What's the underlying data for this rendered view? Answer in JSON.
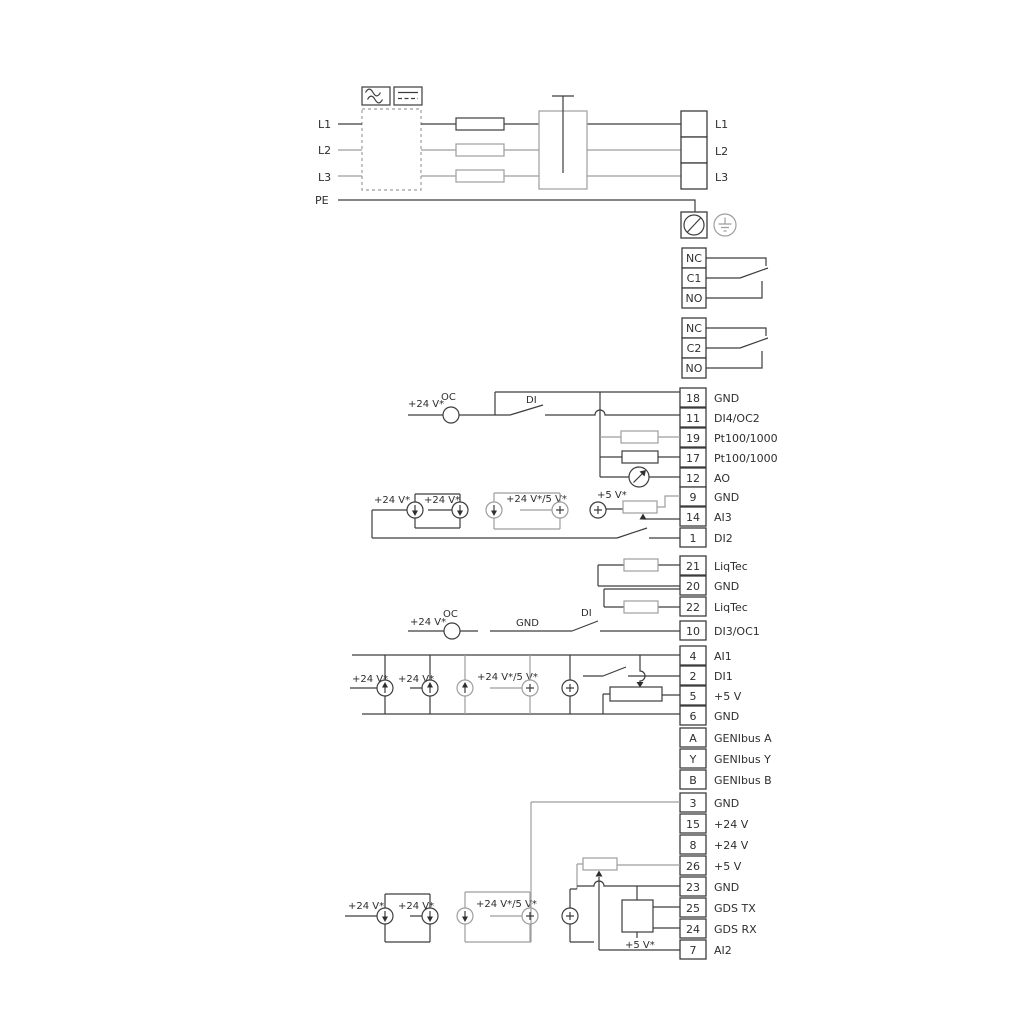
{
  "power": {
    "inputs": [
      "L1",
      "L2",
      "L3",
      "PE"
    ],
    "outputs": [
      "L1",
      "L2",
      "L3"
    ]
  },
  "relays": [
    {
      "cells": [
        "NC",
        "C1",
        "NO"
      ]
    },
    {
      "cells": [
        "NC",
        "C2",
        "NO"
      ]
    }
  ],
  "terminals": [
    {
      "num": "18",
      "label": "GND"
    },
    {
      "num": "11",
      "label": "DI4/OC2"
    },
    {
      "num": "19",
      "label": "Pt100/1000"
    },
    {
      "num": "17",
      "label": "Pt100/1000"
    },
    {
      "num": "12",
      "label": "AO"
    },
    {
      "num": "9",
      "label": "GND"
    },
    {
      "num": "14",
      "label": "AI3"
    },
    {
      "num": "1",
      "label": "DI2"
    },
    {
      "num": "21",
      "label": "LiqTec"
    },
    {
      "num": "20",
      "label": "GND"
    },
    {
      "num": "22",
      "label": "LiqTec"
    },
    {
      "num": "10",
      "label": "DI3/OC1"
    },
    {
      "num": "4",
      "label": "AI1"
    },
    {
      "num": "2",
      "label": "DI1"
    },
    {
      "num": "5",
      "label": "+5 V"
    },
    {
      "num": "6",
      "label": "GND"
    },
    {
      "num": "A",
      "label": "GENIbus A"
    },
    {
      "num": "Y",
      "label": "GENIbus Y"
    },
    {
      "num": "B",
      "label": "GENIbus B"
    },
    {
      "num": "3",
      "label": "GND"
    },
    {
      "num": "15",
      "label": "+24 V"
    },
    {
      "num": "8",
      "label": "+24 V"
    },
    {
      "num": "26",
      "label": "+5 V"
    },
    {
      "num": "23",
      "label": "GND"
    },
    {
      "num": "25",
      "label": "GDS TX"
    },
    {
      "num": "24",
      "label": "GDS RX"
    },
    {
      "num": "7",
      "label": "AI2"
    }
  ],
  "annotations": {
    "top": {
      "v24": "+24 V*",
      "oc": "OC",
      "di": "DI"
    },
    "ai3": {
      "v24a": "+24 V*",
      "v24b": "+24 V*",
      "v245": "+24 V*/5 V*",
      "v5": "+5 V*"
    },
    "mid": {
      "v24": "+24 V*",
      "oc": "OC",
      "gnd": "GND",
      "di": "DI"
    },
    "ai1": {
      "v24a": "+24 V*",
      "v24b": "+24 V*",
      "v245": "+24 V*/5 V*"
    },
    "ai2": {
      "v24a": "+24 V*",
      "v24b": "+24 V*",
      "v245": "+24 V*/5 V*",
      "v5": "+5 V*"
    }
  },
  "colors": {
    "wire_dark": "#3d3d3d",
    "wire_gray": "#9e9e9e",
    "background": "#ffffff"
  }
}
